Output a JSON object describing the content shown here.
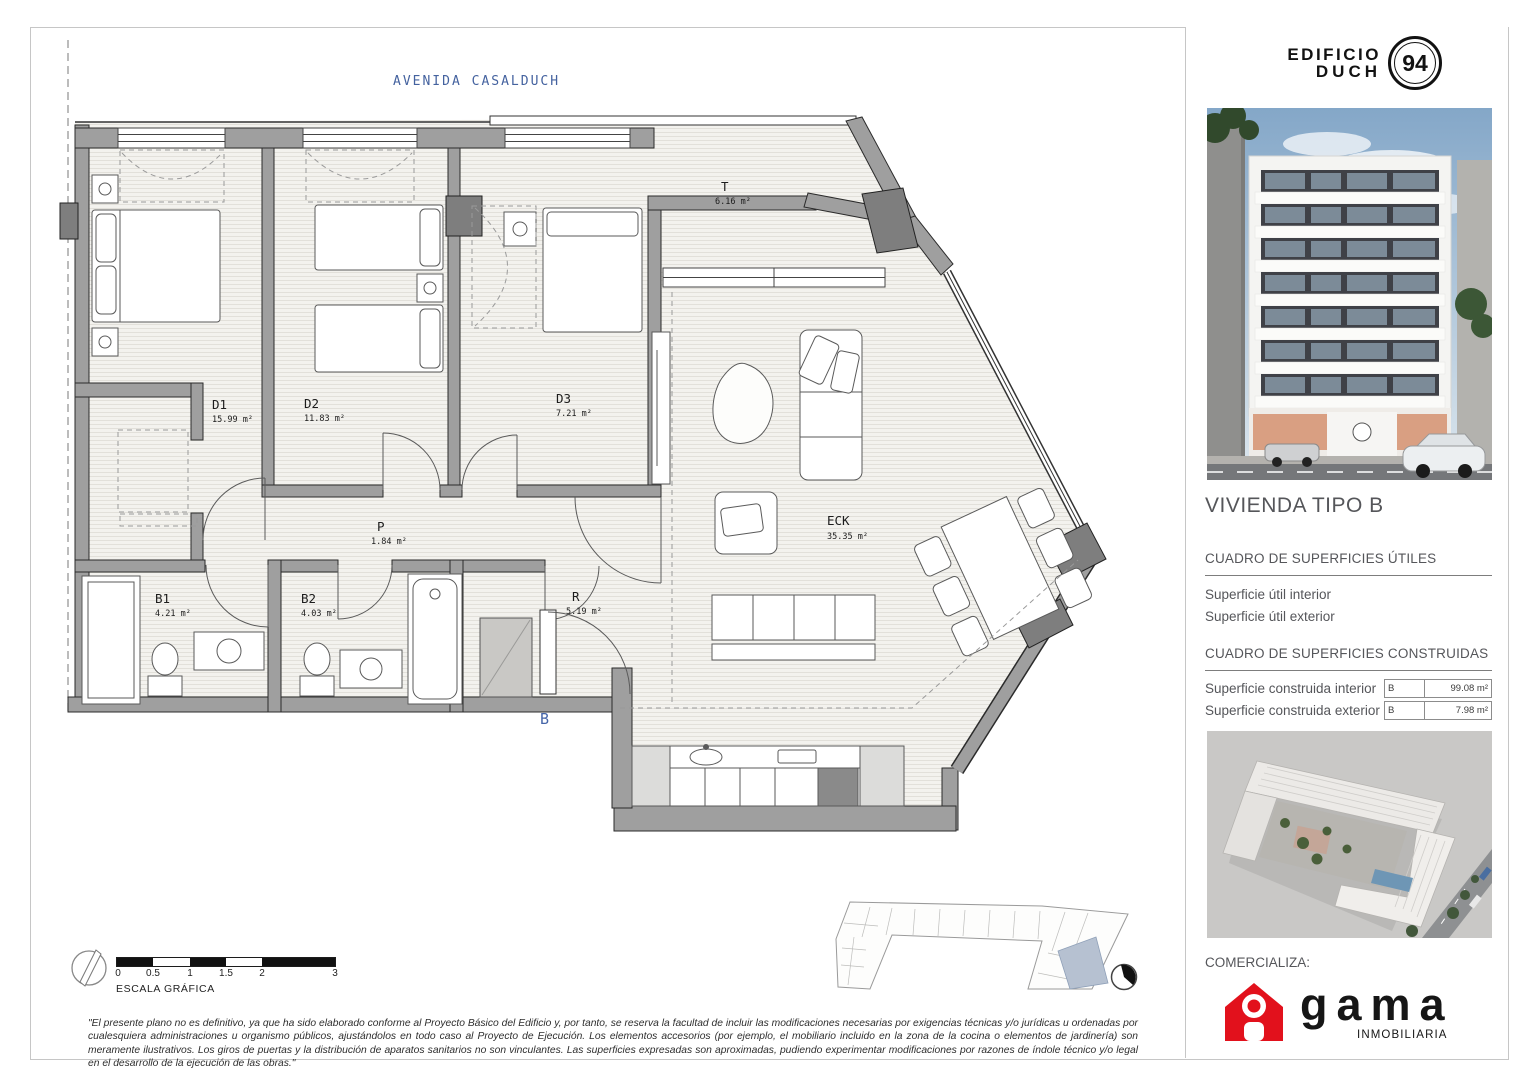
{
  "street_label": "AVENIDA CASALDUCH",
  "plan": {
    "unit_letter": "B",
    "rooms": [
      {
        "id": "D1",
        "area": "15.99 m²"
      },
      {
        "id": "D2",
        "area": "11.83 m²"
      },
      {
        "id": "D3",
        "area": "7.21 m²"
      },
      {
        "id": "T",
        "area": "6.16 m²"
      },
      {
        "id": "P",
        "area": "1.84 m²"
      },
      {
        "id": "B1",
        "area": "4.21 m²"
      },
      {
        "id": "B2",
        "area": "4.03 m²"
      },
      {
        "id": "R",
        "area": "5.19 m²"
      },
      {
        "id": "ECK",
        "area": "35.35 m²"
      }
    ]
  },
  "scale_bar": {
    "label": "ESCALA GRÁFICA",
    "ticks": [
      "0",
      "0.5",
      "1",
      "1.5",
      "2",
      "3"
    ]
  },
  "disclaimer": "\"El presente plano no es definitivo, ya que ha sido elaborado conforme al Proyecto Básico del Edificio y, por tanto, se reserva la facultad de incluir las modificaciones necesarias por exigencias técnicas y/o jurídicas u ordenadas por cualesquiera administraciones u organismo públicos, ajustándolos en todo caso al Proyecto de Ejecución. Los elementos accesorios (por ejemplo, el mobiliario incluido en la zona de la cocina o elementos de jardinería) son meramente ilustrativos. Los giros de puertas y la distribución de aparatos sanitarios no son vinculantes. Las superficies expresadas son aproximadas, pudiendo experimentar modificaciones por razones de índole técnico y/o legal en el desarrollo de la ejecución de las obras.\"",
  "sidebar": {
    "logo": {
      "line1": "EDIFICIO",
      "line2": "DUCH",
      "number": "94"
    },
    "title": "VIVIENDA TIPO B",
    "useful_heading": "CUADRO DE SUPERFICIES ÚTILES",
    "useful_rows": [
      {
        "label": "Superficie útil interior"
      },
      {
        "label": "Superficie útil exterior"
      }
    ],
    "built_heading": "CUADRO DE SUPERFICIES CONSTRUIDAS",
    "built_rows": [
      {
        "label": "Superficie construida interior",
        "type": "B",
        "value": "99.08 m²"
      },
      {
        "label": "Superficie construida exterior",
        "type": "B",
        "value": "7.98 m²"
      }
    ],
    "marketer_label": "COMERCIALIZA:",
    "brand": {
      "name": "gama",
      "subtitle": "INMOBILIARIA"
    }
  },
  "colors": {
    "accent_blue": "#4565a8",
    "brand_red": "#e2111c",
    "wall_gray": "#9f9f9f",
    "dark_block_gray": "#7e7e7e"
  }
}
